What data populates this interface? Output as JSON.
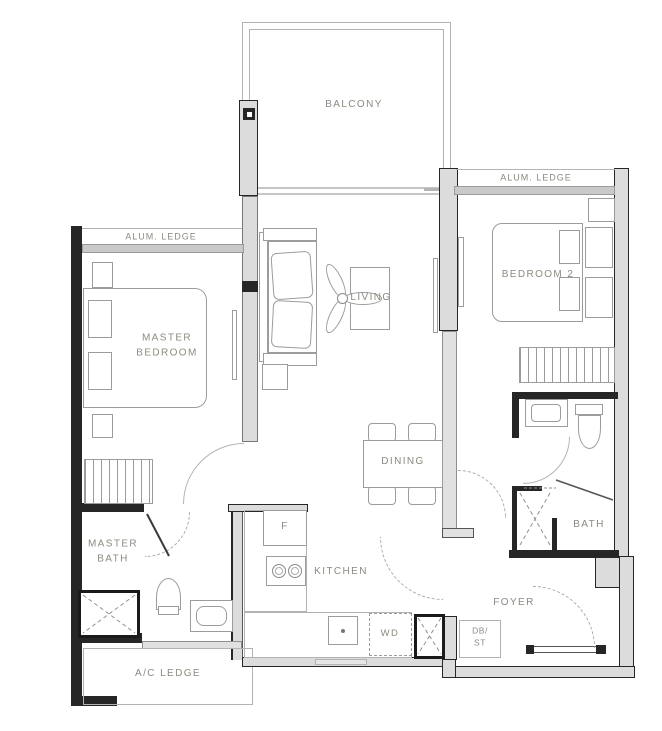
{
  "floorplan": {
    "rooms": {
      "balcony": "BALCONY",
      "living": "LIVING",
      "dining": "DINING",
      "kitchen": "KITCHEN",
      "master_bedroom": "MASTER BEDROOM",
      "bedroom_2": "BEDROOM 2",
      "master_bath": "MASTER BATH",
      "bath": "BATH",
      "foyer": "FOYER",
      "ac_ledge": "A/C LEDGE",
      "alum_ledge_left": "ALUM. LEDGE",
      "alum_ledge_right": "ALUM. LEDGE"
    },
    "fixtures": {
      "fridge": "F",
      "washer_dryer": "WD",
      "db": "DB/",
      "st": "ST"
    },
    "colors": {
      "wall_fill": "#dcdcdc",
      "wall_dark": "#262626",
      "ledge_band": "#c9c9c9",
      "furniture_line": "#9c9c9c",
      "label_text": "#8b8b80",
      "background": "#ffffff"
    }
  }
}
